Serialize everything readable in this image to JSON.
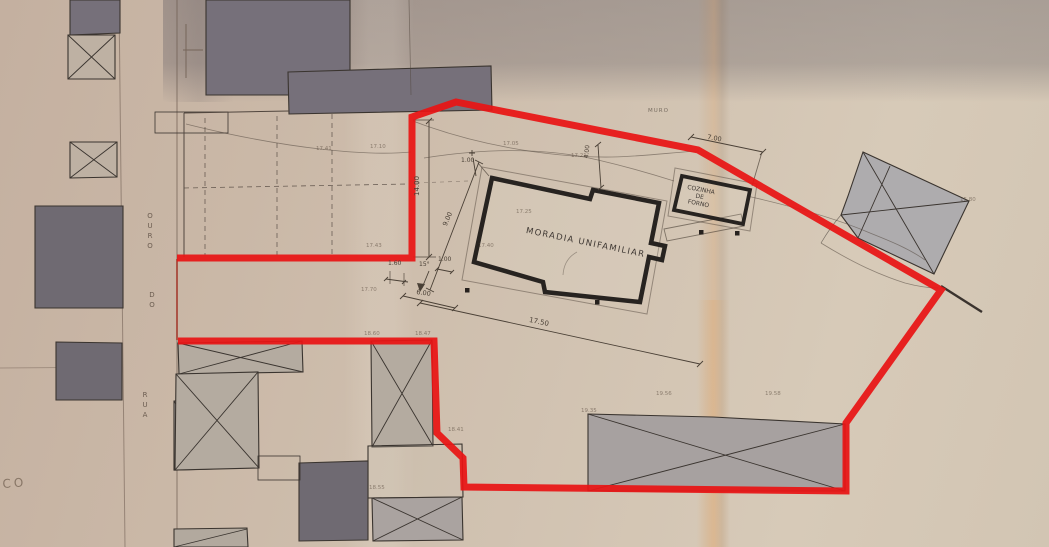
{
  "labels": {
    "house": "MORADIA UNIFAMILIAR",
    "outbuilding_1": "COZINHA",
    "outbuilding_2": "DE",
    "outbuilding_3": "FORNO",
    "wall": "MURO",
    "street_word_1": "OURO",
    "street_word_2": "DO",
    "street_word_3": "RUA",
    "margin_note": "CO"
  },
  "dimensions": {
    "offset_top": "1.00",
    "step_top": "4.00",
    "side_left": "9.00",
    "boundary_left": "14.00",
    "setback": "1.60",
    "angle": "15°",
    "offset_bottom": "1.00",
    "front": "6.00",
    "length": "17.50",
    "outbuilding_offset": "7.00"
  },
  "spot_elevations": [
    "17.41",
    "17.10",
    "17.05",
    "17.21",
    "17.25",
    "17.40",
    "17.43",
    "17.70",
    "18.60",
    "18.47",
    "18.41",
    "18.55",
    "19.35",
    "19.56",
    "19.58",
    "15.80"
  ],
  "colors": {
    "boundary": "#e81414",
    "paper": "#cbbaa9",
    "ink": "#3c3530",
    "building_fill_dark": "#6f6a72",
    "building_fill_shaded": "#aba49c"
  }
}
